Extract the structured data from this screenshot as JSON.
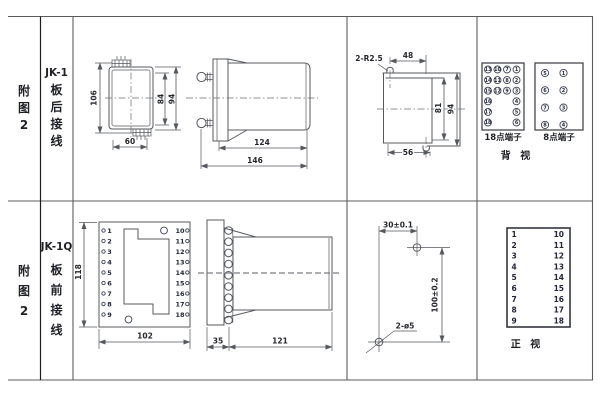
{
  "rows": [
    {
      "figure_chars": [
        "附",
        "图",
        "2"
      ],
      "model": "JK-1",
      "wiring_chars": [
        "板",
        "后",
        "接",
        "线"
      ]
    },
    {
      "figure_chars": [
        "附",
        "图",
        "2"
      ],
      "model": "JK-1Q",
      "wiring_chars": [
        "板",
        "前",
        "接",
        "线"
      ]
    }
  ],
  "rear_outline": {
    "dim_height": "106",
    "dim_inner_height": "84",
    "dim_outer_height": "94",
    "dim_width": "60"
  },
  "rear_side": {
    "dim_body": "124",
    "dim_total": "146"
  },
  "cutout": {
    "slot_note": "2-R2.5",
    "dim_slot_span": "48",
    "dim_inner_height": "81",
    "dim_outer_height": "94",
    "dim_width": "56"
  },
  "rear_terminals": {
    "box18_label": "18点端子",
    "box8_label": "8点端子",
    "view_label": "背 视",
    "grid18": [
      [
        "13",
        "10",
        "7",
        "1"
      ],
      [
        "14",
        "11",
        "8",
        "2"
      ],
      [
        "15",
        "12",
        "9",
        "3"
      ],
      [
        "16",
        "",
        "",
        "4"
      ],
      [
        "17",
        "",
        "",
        "5"
      ],
      [
        "18",
        "",
        "",
        "6"
      ]
    ],
    "grid8": [
      [
        "5",
        "1"
      ],
      [
        "6",
        "2"
      ],
      [
        "7",
        "3"
      ],
      [
        "8",
        "4"
      ]
    ]
  },
  "front_panel": {
    "dim_height": "118",
    "dim_width": "102",
    "left_terminals": [
      "1",
      "2",
      "3",
      "4",
      "5",
      "6",
      "7",
      "8",
      "9"
    ],
    "right_terminals": [
      "10",
      "11",
      "12",
      "13",
      "14",
      "15",
      "16",
      "17",
      "18"
    ]
  },
  "front_side": {
    "dim_plate": "35",
    "dim_body": "121"
  },
  "drill": {
    "dim_h": "30±0.1",
    "dim_v": "100±0.2",
    "hole_note": "2-ø5"
  },
  "front_terminals": {
    "left": [
      "1",
      "2",
      "3",
      "4",
      "5",
      "6",
      "7",
      "8",
      "9"
    ],
    "right": [
      "10",
      "11",
      "12",
      "13",
      "14",
      "15",
      "16",
      "17",
      "18"
    ],
    "view_label": "正 视"
  }
}
